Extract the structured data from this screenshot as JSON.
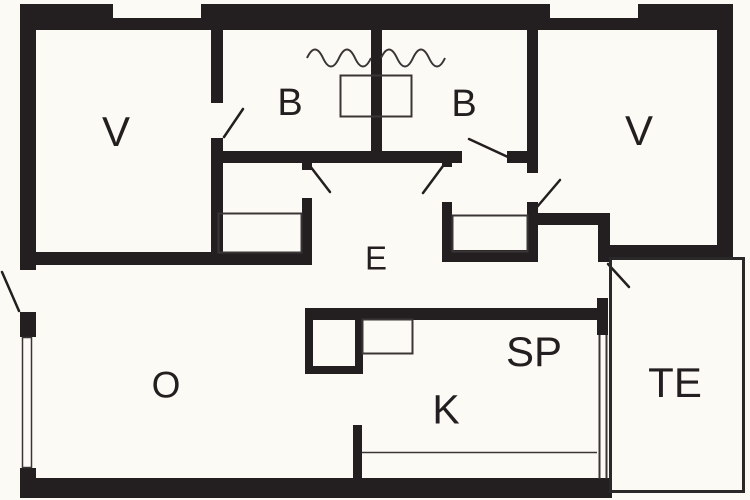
{
  "plan": {
    "type": "floor-plan",
    "rooms": [
      {
        "id": "bedroom-left",
        "label": "V"
      },
      {
        "id": "bath-left",
        "label": "B"
      },
      {
        "id": "bath-right",
        "label": "B"
      },
      {
        "id": "bedroom-right",
        "label": "V"
      },
      {
        "id": "hall",
        "label": "E"
      },
      {
        "id": "living-room",
        "label": "O"
      },
      {
        "id": "dining",
        "label": "SP"
      },
      {
        "id": "kitchen",
        "label": "K"
      },
      {
        "id": "terrace",
        "label": "TE"
      }
    ],
    "colors": {
      "wall": "#231f20",
      "thin_line": "#3a3637",
      "background": "#fcfaf5",
      "window_fill": "#fcfaf5"
    }
  }
}
